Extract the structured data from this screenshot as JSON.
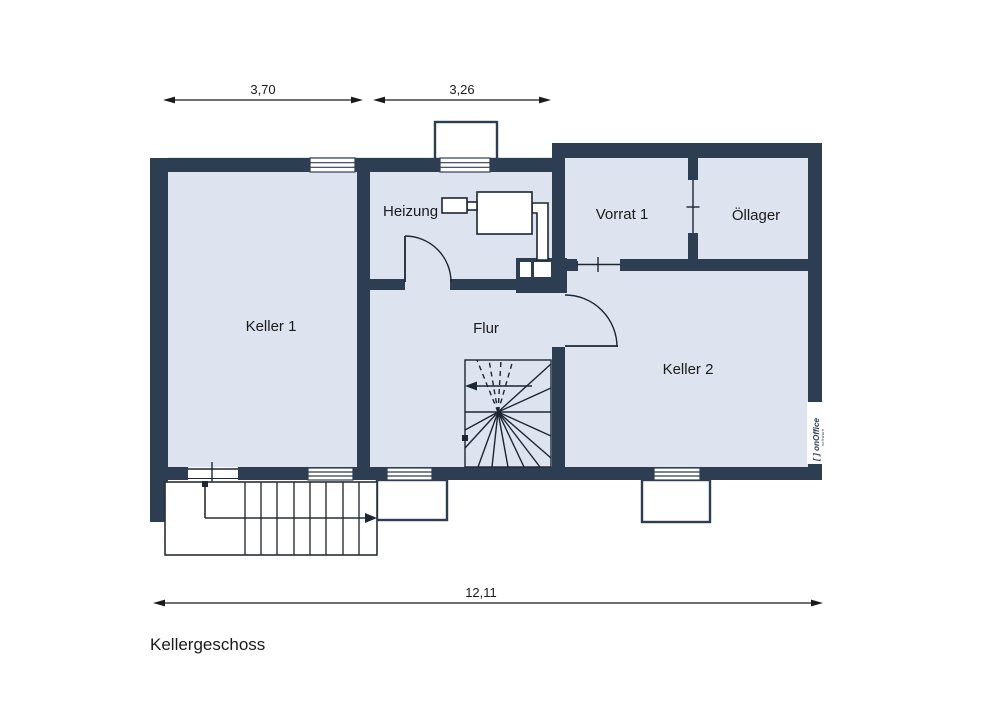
{
  "title": "Kellergeschoss",
  "dimensions": {
    "top_left": "3,70",
    "top_right": "3,26",
    "overall_width": "12,11"
  },
  "rooms": {
    "keller1": "Keller 1",
    "heizung": "Heizung",
    "flur": "Flur",
    "vorrat1": "Vorrat 1",
    "oellager": "Öllager",
    "keller2": "Keller 2"
  },
  "logo": {
    "full": "[ ] onOffice",
    "subtitle": "software"
  },
  "colors": {
    "wall": "#2e3e52",
    "room_fill": "#dde3ef",
    "outline": "#1c2733",
    "dimension": "#1a1a1a",
    "background": "#ffffff"
  }
}
